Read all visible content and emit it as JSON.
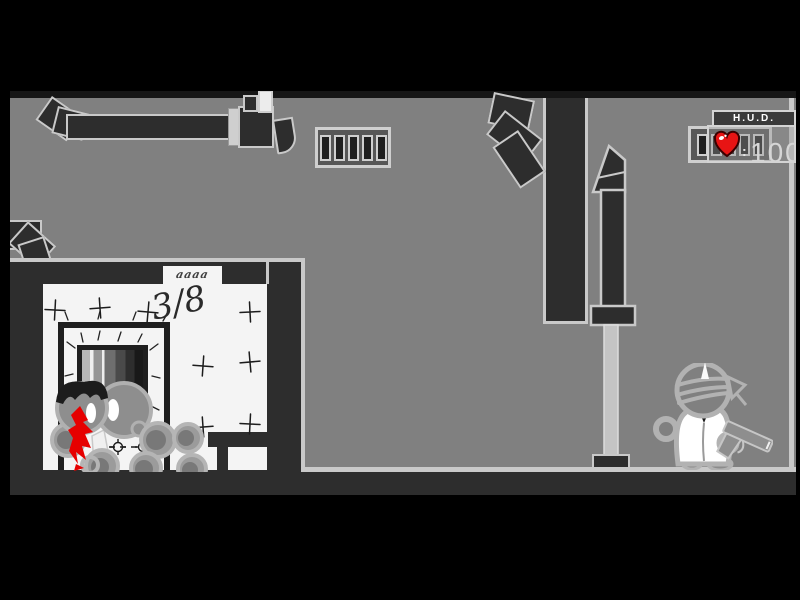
{
  "window": {
    "width": 800,
    "height": 600,
    "kind": "flash-game-scene"
  },
  "hud": {
    "title": "H.U.D.",
    "health": {
      "icon": "heart-icon",
      "separator": ":",
      "value": "100"
    }
  },
  "scene": {
    "room_progress_label": "3/8",
    "door_sign_scribble": "aaaa",
    "colors": {
      "background_gray": "#808080",
      "structure_dark": "#2d2d2d",
      "outline_light": "#c9c9c9",
      "cell_white": "#f4f4f4",
      "blood_red": "#e60000",
      "heart_red": "#e81414",
      "frame_black": "#000000"
    }
  }
}
